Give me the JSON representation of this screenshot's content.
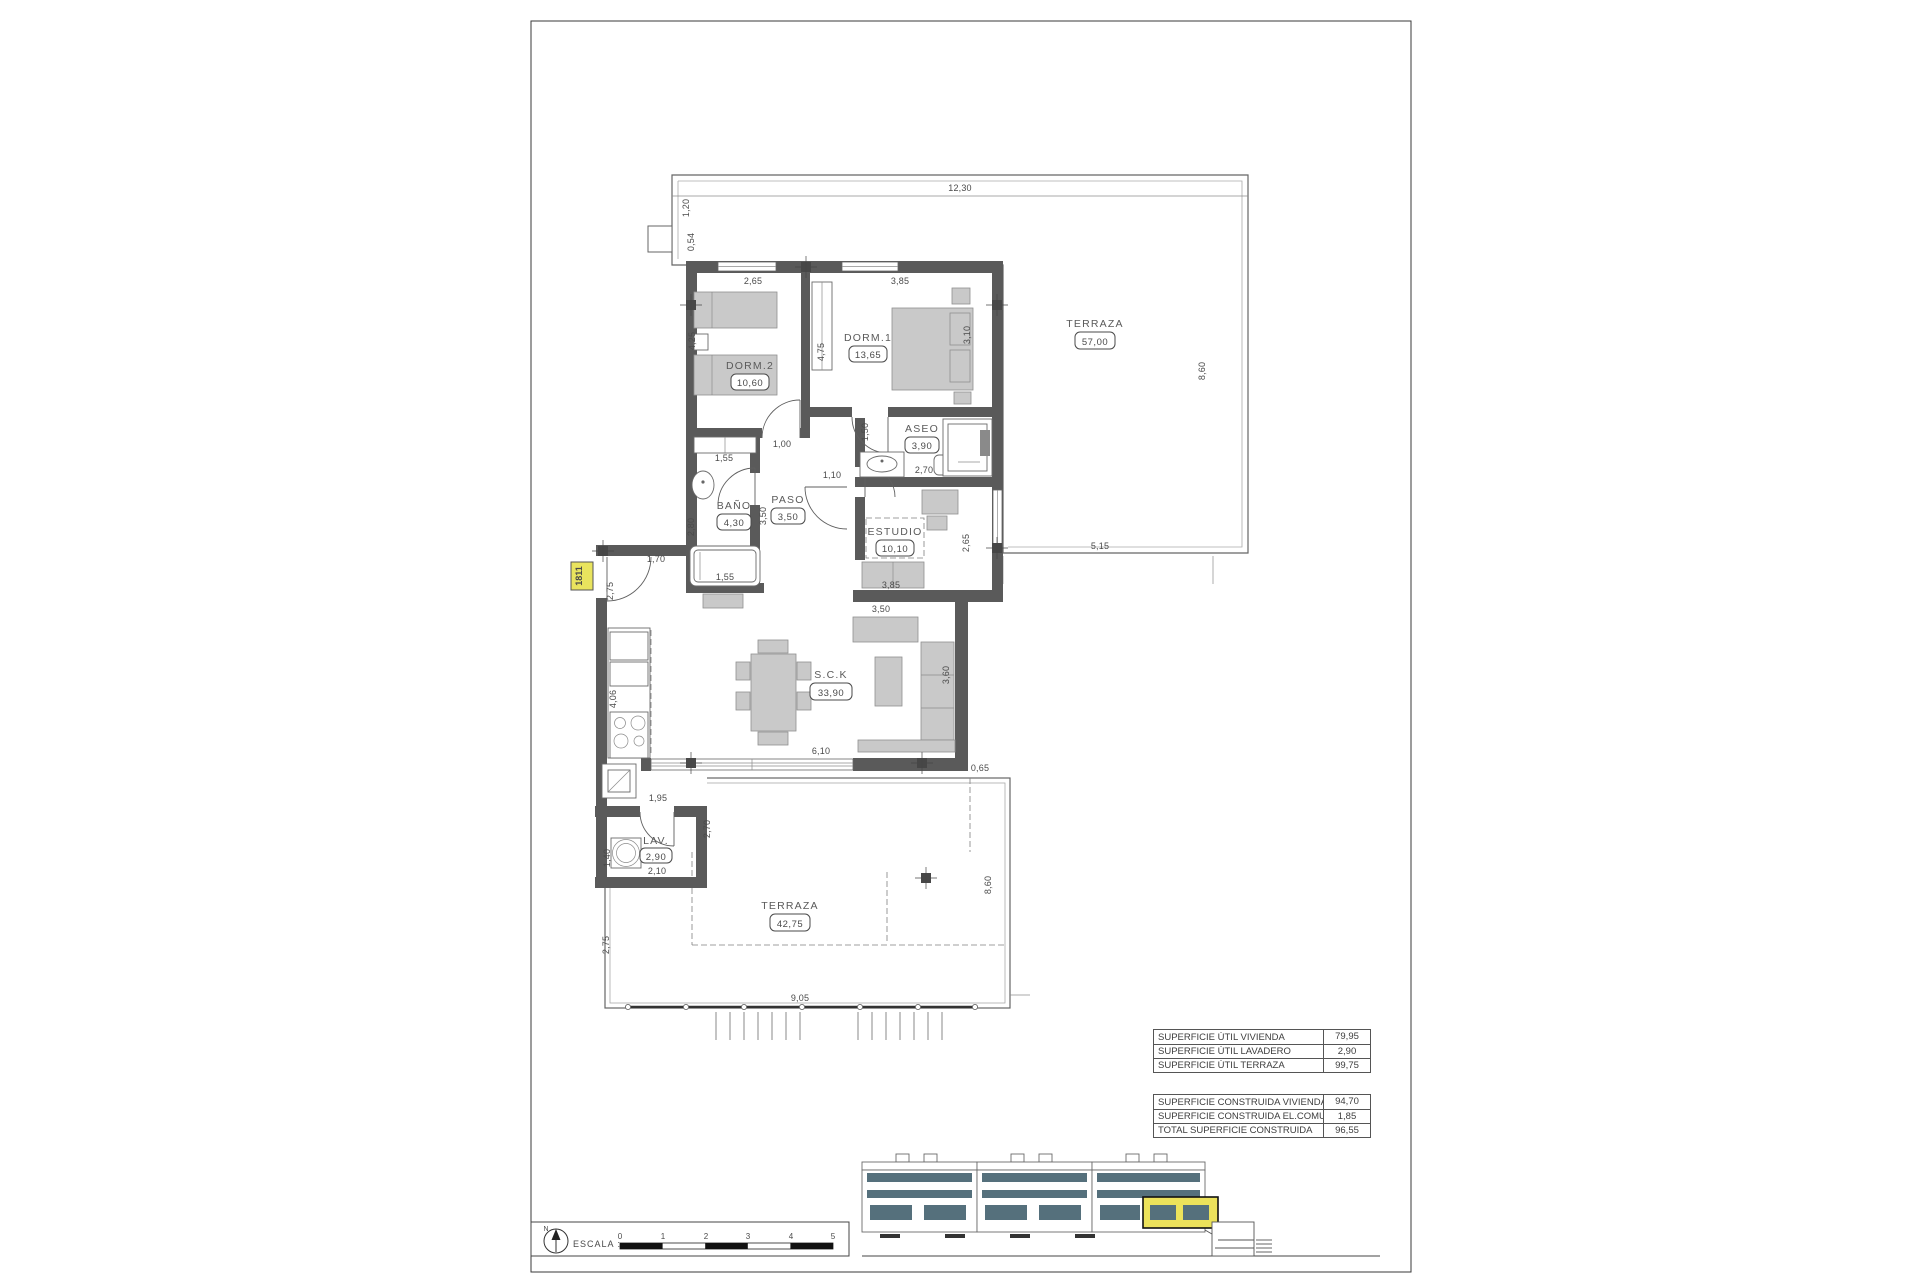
{
  "sheet": {
    "unit_tag": "1811",
    "north_label": "N",
    "scale_label": "ESCALA :",
    "scale_ticks": [
      "0",
      "1",
      "2",
      "3",
      "4",
      "5"
    ]
  },
  "rooms": {
    "dorm2": {
      "name": "DORM.2",
      "area": "10,60"
    },
    "dorm1": {
      "name": "DORM.1",
      "area": "13,65"
    },
    "aseo": {
      "name": "ASEO",
      "area": "3,90"
    },
    "bano": {
      "name": "BAÑO",
      "area": "4,30"
    },
    "paso": {
      "name": "PASO",
      "area": "3,50"
    },
    "estudio": {
      "name": "ESTUDIO",
      "area": "10,10"
    },
    "sck": {
      "name": "S.C.K",
      "area": "33,90"
    },
    "lav": {
      "name": "LAV.",
      "area": "2,90"
    },
    "terraza_top": {
      "name": "TERRAZA",
      "area": "57,00"
    },
    "terraza_bottom": {
      "name": "TERRAZA",
      "area": "42,75"
    }
  },
  "dims": {
    "top_w": "12,30",
    "top_l1": "1,20",
    "top_l2": "0,54",
    "tt_r": "8,60",
    "tt_b": "5,15",
    "d2_w": "2,65",
    "d1_w": "3,85",
    "d2_h": "4,25",
    "d1_h": "4,75",
    "d1_r": "3,10",
    "d2_closet": "1,55",
    "d2_door": "1,00",
    "hall": "1,10",
    "aseo_door": "1,50",
    "aseo_w": "2,70",
    "bano_h": "2,80",
    "tub": "1,55",
    "paso_l": "3,50",
    "est_r": "2,65",
    "est_w": "3,85",
    "sofa": "3,50",
    "sck_r": "3,60",
    "sck_b": "6,10",
    "gap_r": "0,65",
    "kit_h": "4,06",
    "kit_b": "1,95",
    "lav_l": "1,40",
    "lav_b": "2,10",
    "lav_r": "2,70",
    "entry": "1,70",
    "entry_s": "2,75",
    "bt_l": "2,75",
    "bt_w": "9,05",
    "bt_r": "8,60"
  },
  "tables": {
    "utiles": {
      "rows": [
        {
          "label": "SUPERFICIE ÚTIL VIVIENDA",
          "value": "79,95"
        },
        {
          "label": "SUPERFICIE ÚTIL LAVADERO",
          "value": "2,90"
        },
        {
          "label": "SUPERFICIE ÚTIL TERRAZA",
          "value": "99,75"
        }
      ]
    },
    "construida": {
      "rows": [
        {
          "label": "SUPERFICIE CONSTRUIDA VIVIENDA",
          "value": "94,70"
        },
        {
          "label": "SUPERFICIE CONSTRUIDA EL.COMUNES",
          "value": "1,85"
        },
        {
          "label": "TOTAL SUPERFICIE CONSTRUIDA",
          "value": "96,55"
        }
      ]
    }
  }
}
